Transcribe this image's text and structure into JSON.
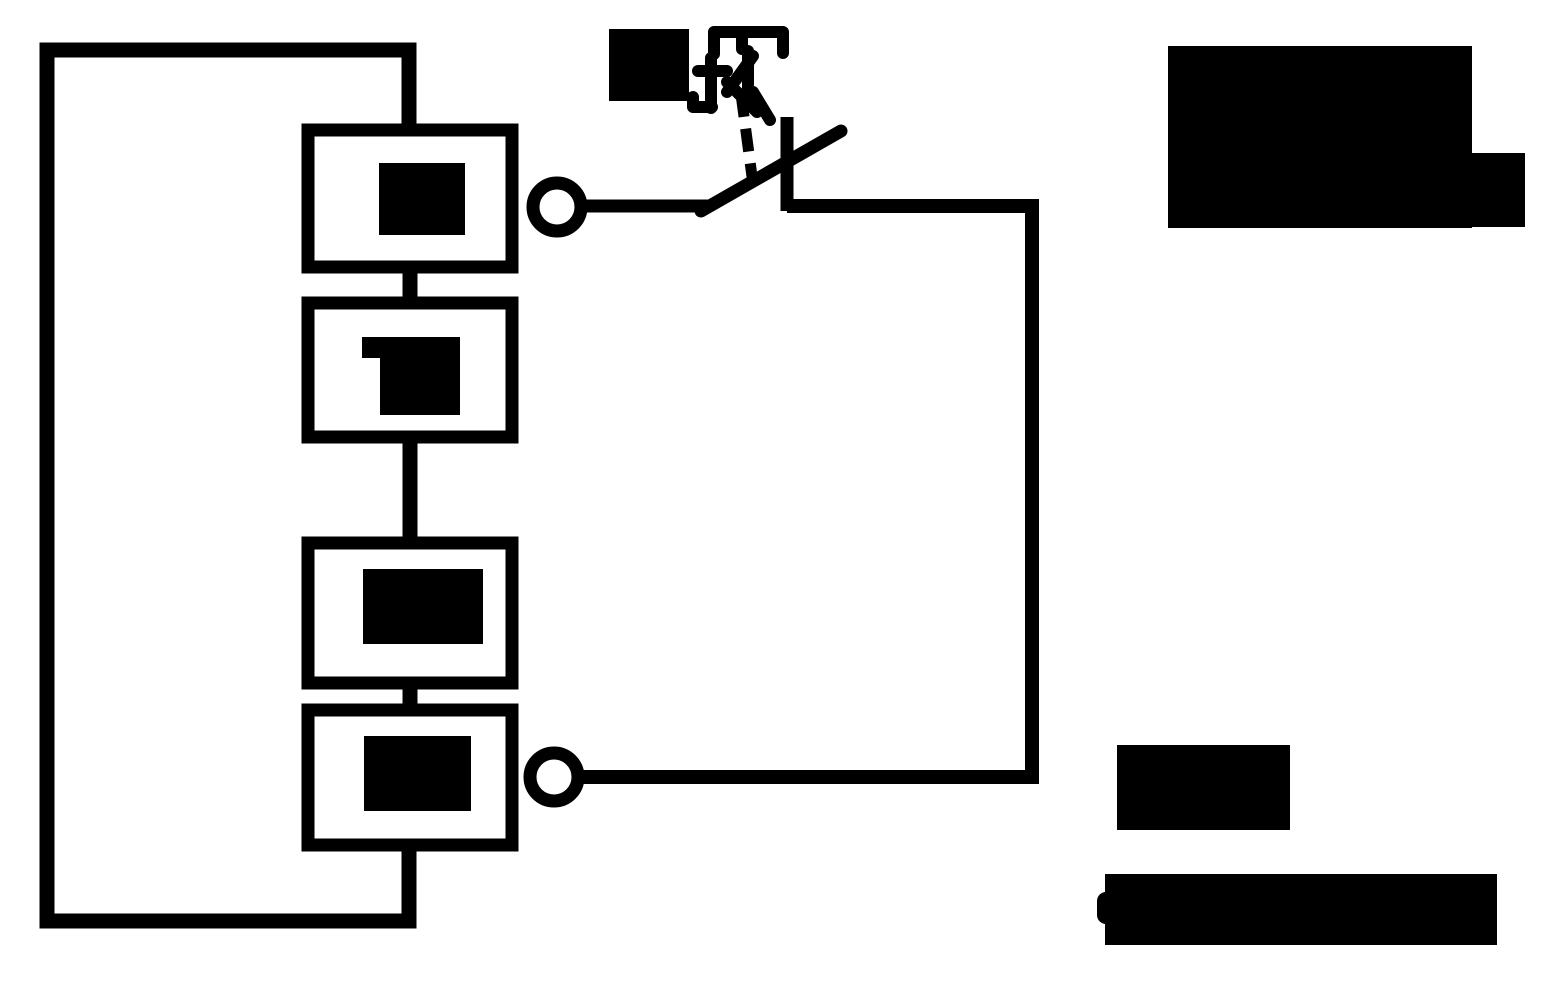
{
  "canvas": {
    "width": 1546,
    "height": 992,
    "background": "#ffffff",
    "ink": "#000000"
  },
  "diagram": {
    "type": "circuit-diagram",
    "description": "Closed rectangular wire loop containing four series component boxes; each box label is a redacted solid-black block. Two ring terminals beside the top and bottom boxes are joined through an open knife switch (diagonal blade crossing a vertical riser) whose dashed mechanical link rises to an illegible garbled actuator glyph with a redacted square label. Three additional fully redacted black text blocks sit at the top right and bottom right.",
    "legible_text": [],
    "components": [
      {
        "id": "outer-loop-wire",
        "role": "series circuit loop conductor",
        "bbox": [
          40,
          43,
          377,
          885
        ]
      },
      {
        "id": "component-box-1",
        "role": "series component (label redacted)",
        "bbox": [
          308,
          130,
          204,
          137
        ],
        "redacted": true
      },
      {
        "id": "component-box-2",
        "role": "series component (label redacted)",
        "bbox": [
          308,
          303,
          204,
          134
        ],
        "redacted": true
      },
      {
        "id": "component-box-3",
        "role": "series component (label redacted)",
        "bbox": [
          308,
          543,
          204,
          140
        ],
        "redacted": true
      },
      {
        "id": "component-box-4",
        "role": "series component (label redacted)",
        "bbox": [
          308,
          710,
          204,
          135
        ],
        "redacted": true
      },
      {
        "id": "terminal-top",
        "role": "ring terminal tap",
        "center": [
          557,
          207
        ],
        "radius": 24
      },
      {
        "id": "terminal-bottom",
        "role": "ring terminal tap",
        "center": [
          554,
          777
        ],
        "radius": 24
      },
      {
        "id": "knife-switch",
        "role": "open switch blade crossing riser",
        "bbox": [
          700,
          117,
          145,
          96
        ]
      },
      {
        "id": "mechanical-link",
        "role": "dashed actuator linkage",
        "from": [
          741,
          94
        ],
        "to": [
          753,
          184
        ]
      },
      {
        "id": "actuator-glyph",
        "role": "illegible garbled symbol above switch",
        "bbox": [
          692,
          28,
          93,
          94
        ],
        "redacted": true
      },
      {
        "id": "switch-label",
        "role": "switch designation (redacted block)",
        "bbox": [
          609,
          29,
          80,
          72
        ],
        "redacted": true
      },
      {
        "id": "right-return-wire",
        "role": "conductor from switch to bottom terminal",
        "path": [
          [
            787,
            206
          ],
          [
            1032,
            206
          ],
          [
            1032,
            777
          ],
          [
            580,
            777
          ]
        ]
      }
    ]
  },
  "redactions": {
    "box_labels": [
      {
        "id": "redacted-label-1",
        "bbox": [
          379,
          163,
          86,
          72
        ]
      },
      {
        "id": "redacted-label-2",
        "bbox": [
          362,
          337,
          98,
          78
        ]
      },
      {
        "id": "redacted-label-3",
        "bbox": [
          363,
          569,
          120,
          75
        ]
      },
      {
        "id": "redacted-label-4",
        "bbox": [
          364,
          736,
          107,
          75
        ]
      }
    ],
    "text_blocks": [
      {
        "id": "redacted-text-top-right-main",
        "bbox": [
          1168,
          46,
          304,
          182
        ]
      },
      {
        "id": "redacted-text-top-right-ext",
        "bbox": [
          1472,
          153,
          53,
          74
        ]
      },
      {
        "id": "redacted-text-bottom-right-1",
        "bbox": [
          1117,
          745,
          173,
          85
        ]
      },
      {
        "id": "redacted-text-bottom-right-2",
        "bbox": [
          1105,
          874,
          392,
          71
        ]
      }
    ]
  }
}
